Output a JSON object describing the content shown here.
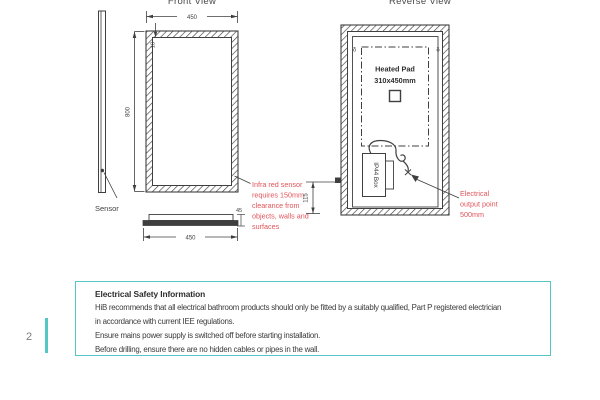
{
  "page": {
    "number": "2"
  },
  "colors": {
    "line": "#3f3f3f",
    "red": "#e25359",
    "teal": "#56c5c6"
  },
  "front_view": {
    "title": "Front View",
    "sensor_label": "Sensor",
    "dims": {
      "width_top": "450",
      "height": "800",
      "frame": "18",
      "depth": "45",
      "width_bottom": "450"
    },
    "annotation": [
      "Infra red sensor",
      "requires 150mm",
      "clearance from",
      "objects, walls and",
      "surfaces"
    ]
  },
  "reverse_view": {
    "title": "Reverse View",
    "heated_pad": {
      "label": "Heated Pad",
      "size": "310x450mm"
    },
    "ip44_label": "IP44 Box",
    "dims": {
      "outlet_height": "115"
    },
    "annotation": [
      "Electrical",
      "output point",
      "500mm"
    ],
    "hanger_glyph": "δ"
  },
  "info_box": {
    "title": "Electrical Safety Information",
    "lines": [
      "HiB recommends that all electrical bathroom products should only be fitted by a suitably qualified, Part P registered electrician",
      "in accordance with current IEE regulations.",
      "Ensure mains power supply is switched off before starting installation.",
      "Before drilling, ensure there are no hidden cables or pipes in the wall."
    ]
  }
}
